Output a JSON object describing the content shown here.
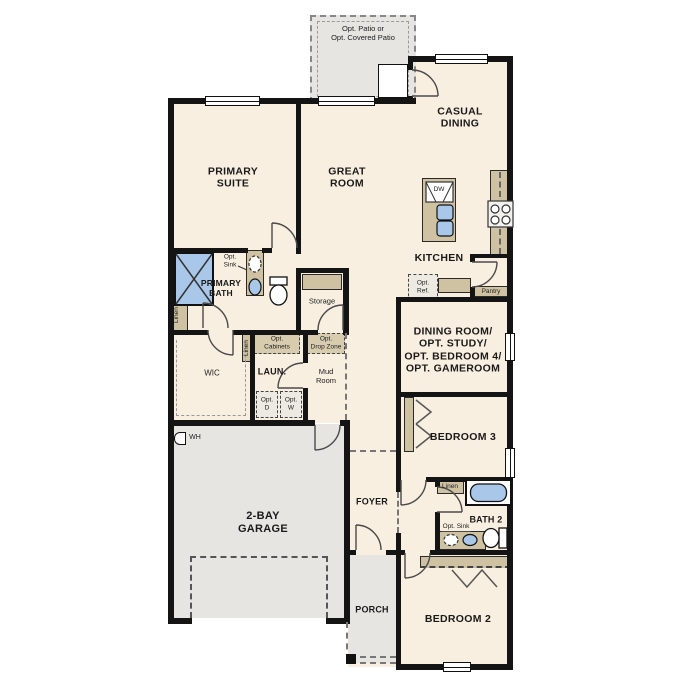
{
  "plan": {
    "rooms": {
      "primary_suite": "PRIMARY\nSUITE",
      "great_room": "GREAT\nROOM",
      "casual_dining": "CASUAL\nDINING",
      "kitchen": "KITCHEN",
      "dining_flex": "DINING ROOM/\nOPT. STUDY/\nOPT. BEDROOM 4/\nOPT. GAMEROOM",
      "primary_bath": "PRIMARY\nBATH",
      "wic": "WIC",
      "laundry": "LAUN.",
      "mud_room": "Mud\nRoom",
      "storage": "Storage",
      "pantry": "Pantry",
      "foyer": "FOYER",
      "bedroom_2": "BEDROOM 2",
      "bedroom_3": "BEDROOM 3",
      "bath_2": "BATH 2",
      "garage": "2-BAY\nGARAGE",
      "porch": "PORCH",
      "patio": "Opt. Patio or\nOpt. Covered Patio"
    },
    "annotations": {
      "opt_sink": "Opt.\nSink",
      "opt_sink_inline": "Opt. Sink",
      "opt_cabinets": "Opt.\nCabinets",
      "opt_drop_zone": "Opt.\nDrop Zone",
      "opt_dryer": "Opt.\nD",
      "opt_washer": "Opt.\nW",
      "opt_ref": "Opt.\nRef.",
      "linen": "Linen",
      "water_heater": "WH",
      "dishwasher": "DW"
    },
    "colors": {
      "floor": "#f8efe0",
      "outdoor": "#e6e5e1",
      "cabinet": "#cfc2a3",
      "fixture_blue": "#a9c7e9",
      "wall": "#141414"
    }
  }
}
